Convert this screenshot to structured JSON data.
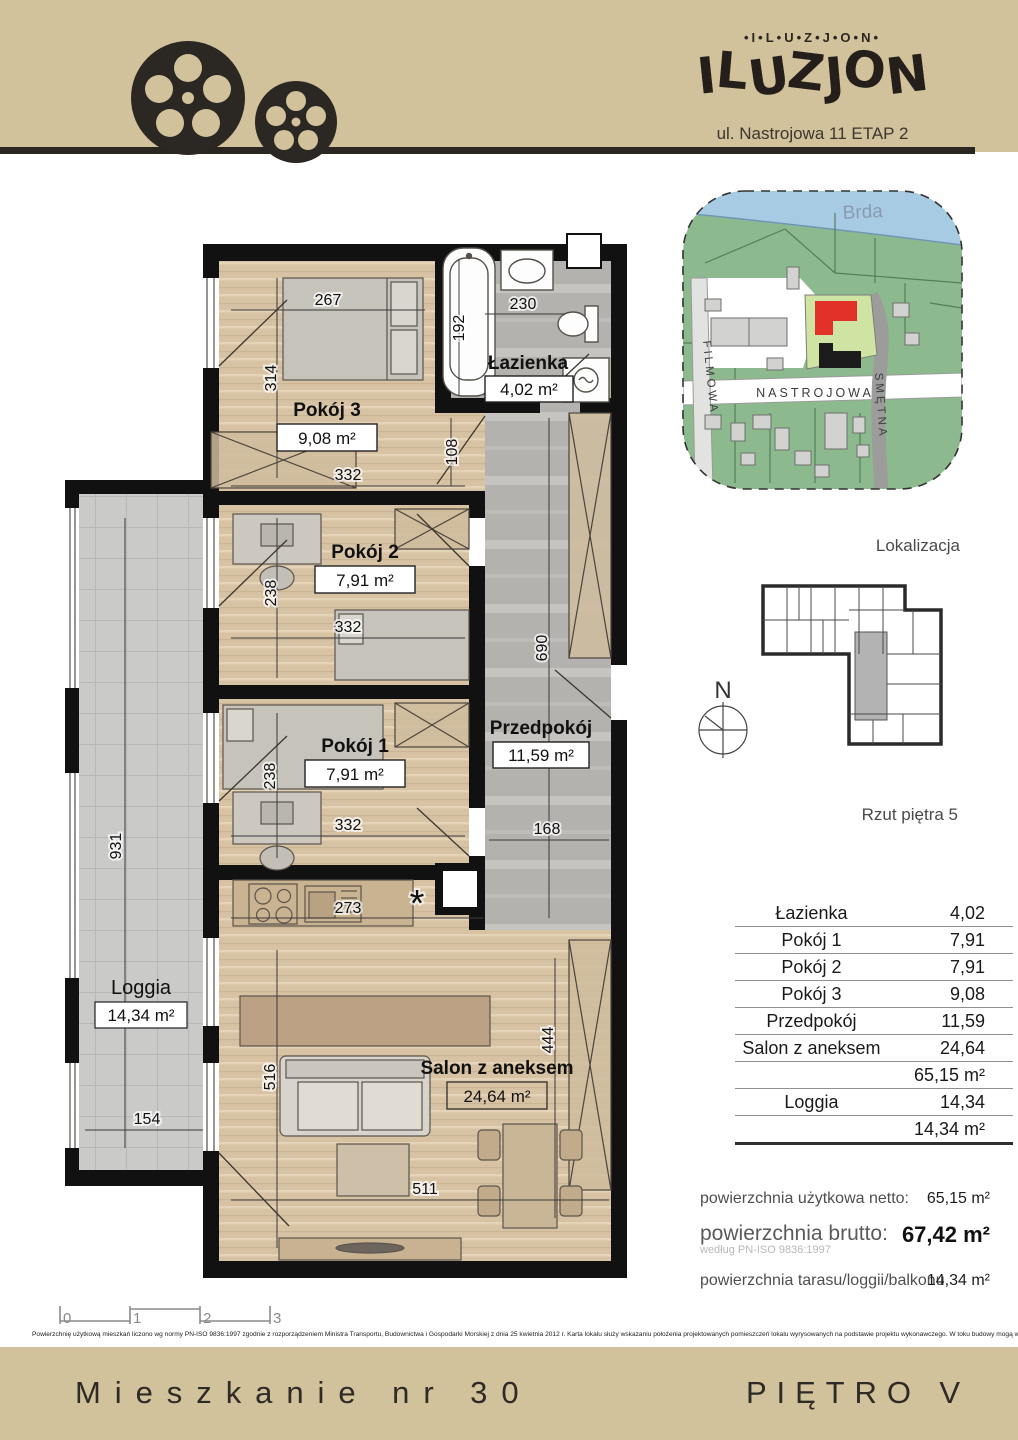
{
  "header": {
    "brand_small": "•I•L•U•Z•J•O•N•",
    "logo_letters": [
      "I",
      "L",
      "U",
      "Z",
      "J",
      "O",
      "N"
    ],
    "address": "ul. Nastrojowa 11 ETAP 2"
  },
  "map": {
    "river": "Brda",
    "street_left": "FILMOWA",
    "street_main": "NASTROJOWA",
    "street_right": "SMĘTNA",
    "caption": "Lokalizacja"
  },
  "floor_overview": {
    "compass": "N",
    "caption": "Rzut piętra 5"
  },
  "plan": {
    "rooms": {
      "pokoj3": {
        "name": "Pokój 3",
        "area": "9,08 m²"
      },
      "lazienka": {
        "name": "Łazienka",
        "area": "4,02 m²"
      },
      "pokoj2": {
        "name": "Pokój 2",
        "area": "7,91 m²"
      },
      "pokoj1": {
        "name": "Pokój 1",
        "area": "7,91 m²"
      },
      "przedpokoj": {
        "name": "Przedpokój",
        "area": "11,59 m²"
      },
      "salon": {
        "name": "Salon z aneksem",
        "area": "24,64 m²"
      },
      "loggia": {
        "name": "Loggia",
        "area": "14,34 m²"
      }
    },
    "dims": {
      "d267": "267",
      "d230": "230",
      "d192": "192",
      "d314": "314",
      "d108": "108",
      "d332a": "332",
      "d238a": "238",
      "d332b": "332",
      "d238b": "238",
      "d332c": "332",
      "d690": "690",
      "d168": "168",
      "d931": "931",
      "d273": "273",
      "d516": "516",
      "d444": "444",
      "d154": "154",
      "d511": "511",
      "asterisk": "*"
    }
  },
  "table": {
    "rows": [
      {
        "label": "Łazienka",
        "value": "4,02"
      },
      {
        "label": "Pokój 1",
        "value": "7,91"
      },
      {
        "label": "Pokój 2",
        "value": "7,91"
      },
      {
        "label": "Pokój 3",
        "value": "9,08"
      },
      {
        "label": "Przedpokój",
        "value": "11,59"
      },
      {
        "label": "Salon z aneksem",
        "value": "24,64"
      },
      {
        "label": "",
        "value": "65,15 m²"
      },
      {
        "label": "Loggia",
        "value": "14,34"
      },
      {
        "label": "",
        "value": "14,34 m²"
      }
    ]
  },
  "summary": {
    "netto_label": "powierzchnia użytkowa netto:",
    "netto_value": "65,15 m²",
    "brutto_label": "powierzchnia brutto:",
    "brutto_value": "67,42 m²",
    "brutto_note": "według PN-ISO 9836:1997",
    "taras_label": "powierzchnia tarasu/loggii/balkonu",
    "taras_value": "14,34 m²"
  },
  "scalebar": {
    "t0": "0",
    "t1": "1",
    "t2": "2",
    "t3": "3"
  },
  "disclaimer": "Powierzchnię użytkową mieszkań liczono wg normy PN-ISO 9836:1997 zgodnie z rozporządzeniem Ministra Transportu, Budownictwa i Gospodarki Morskiej z dnia 25 kwietnia 2012 r. Karta lokalu służy wskazaniu położenia projektowanych pomieszczeń lokalu wyrysowanych na podstawie projektu wykonawczego. W toku budowy mogą wystąpić niewielkie zmiany w stosunku do informacji zawartych w karcie katalogowej.",
  "footer": {
    "left": "Mieszkanie nr 30",
    "right": "PIĘTRO V"
  },
  "colors": {
    "band": "#d1c29c",
    "wall": "#111111",
    "wood": "#d7c3a4",
    "gray_floor": "#b4b2ae",
    "loggia_floor": "#cacac8",
    "highlight_red": "#e23128",
    "river_blue": "#a7cbe3",
    "map_green": "#8cba8e"
  }
}
